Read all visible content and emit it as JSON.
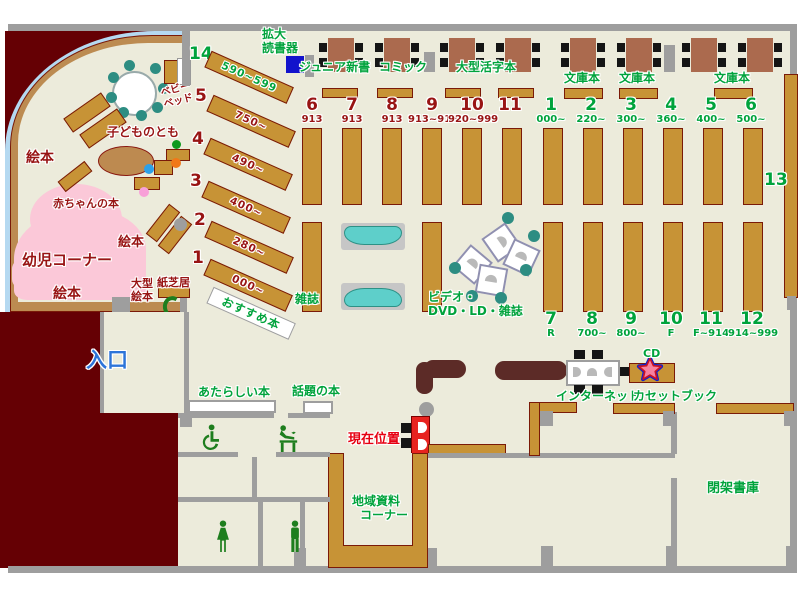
{
  "colors": {
    "floor": "#ecebdb",
    "exterior": "#650004",
    "shelf": "#c79336",
    "green_label": "#00a33c",
    "red_label": "#981414",
    "entrance_blue": "#2d74d9",
    "location_red": "#e60012",
    "pink_area": "#fbc8d8"
  },
  "top": {
    "kakudai1": "拡大",
    "kakudai2": "読書器",
    "junior": "ジュニア新書",
    "comic": "コミック",
    "large_print": "大型活字本",
    "bunko_a": "文庫本",
    "bunko_b": "文庫本",
    "bunko_c": "文庫本"
  },
  "children": {
    "kodomo": "子どものとも",
    "baby1": "ベビー",
    "baby2": "ベッド",
    "ehon_a": "絵本",
    "ehon_b": "絵本",
    "ehon_c": "絵本",
    "akachan": "赤ちゃんの本",
    "yoji": "幼児コーナー",
    "ogata1": "大型",
    "ogata2": "絵本",
    "kamishibai": "紙芝居",
    "shelf14": {
      "num": "14",
      "range": "590~599"
    },
    "diag": [
      {
        "num": "5",
        "range": "750~"
      },
      {
        "num": "4",
        "range": "490~"
      },
      {
        "num": "3",
        "range": "400~"
      },
      {
        "num": "2",
        "range": "280~"
      },
      {
        "num": "1",
        "range": "000~"
      }
    ],
    "osusume": "おすすめ本"
  },
  "stacks": {
    "row1_left": [
      {
        "num": "6",
        "range": "913"
      },
      {
        "num": "7",
        "range": "913"
      },
      {
        "num": "8",
        "range": "913"
      },
      {
        "num": "9",
        "range": "913~919"
      },
      {
        "num": "10",
        "range": "920~999"
      },
      {
        "num": "11",
        "range": ""
      }
    ],
    "row1_right": [
      {
        "num": "1",
        "range": "000~"
      },
      {
        "num": "2",
        "range": "220~"
      },
      {
        "num": "3",
        "range": "300~"
      },
      {
        "num": "4",
        "range": "360~"
      },
      {
        "num": "5",
        "range": "400~"
      },
      {
        "num": "6",
        "range": "500~"
      }
    ],
    "row2": [
      {
        "num": "7",
        "range": "R"
      },
      {
        "num": "8",
        "range": "700~"
      },
      {
        "num": "9",
        "range": "800~"
      },
      {
        "num": "10",
        "range": "F"
      },
      {
        "num": "11",
        "range": "F~914"
      },
      {
        "num": "12",
        "range": "914~999"
      }
    ],
    "s13": "13",
    "zasshi": "雑誌",
    "video1": "ビデオ・",
    "video2": "DVD・LD・雑誌"
  },
  "bottom": {
    "entrance": "入口",
    "new_books": "あたらしい本",
    "topic_books": "話題の本",
    "location": "現在位置",
    "local1": "地域資料",
    "local2": "コーナー",
    "internet": "インターネット",
    "cassette": "カセットブック",
    "cd": "CD",
    "stacks_closed": "閉架書庫"
  }
}
